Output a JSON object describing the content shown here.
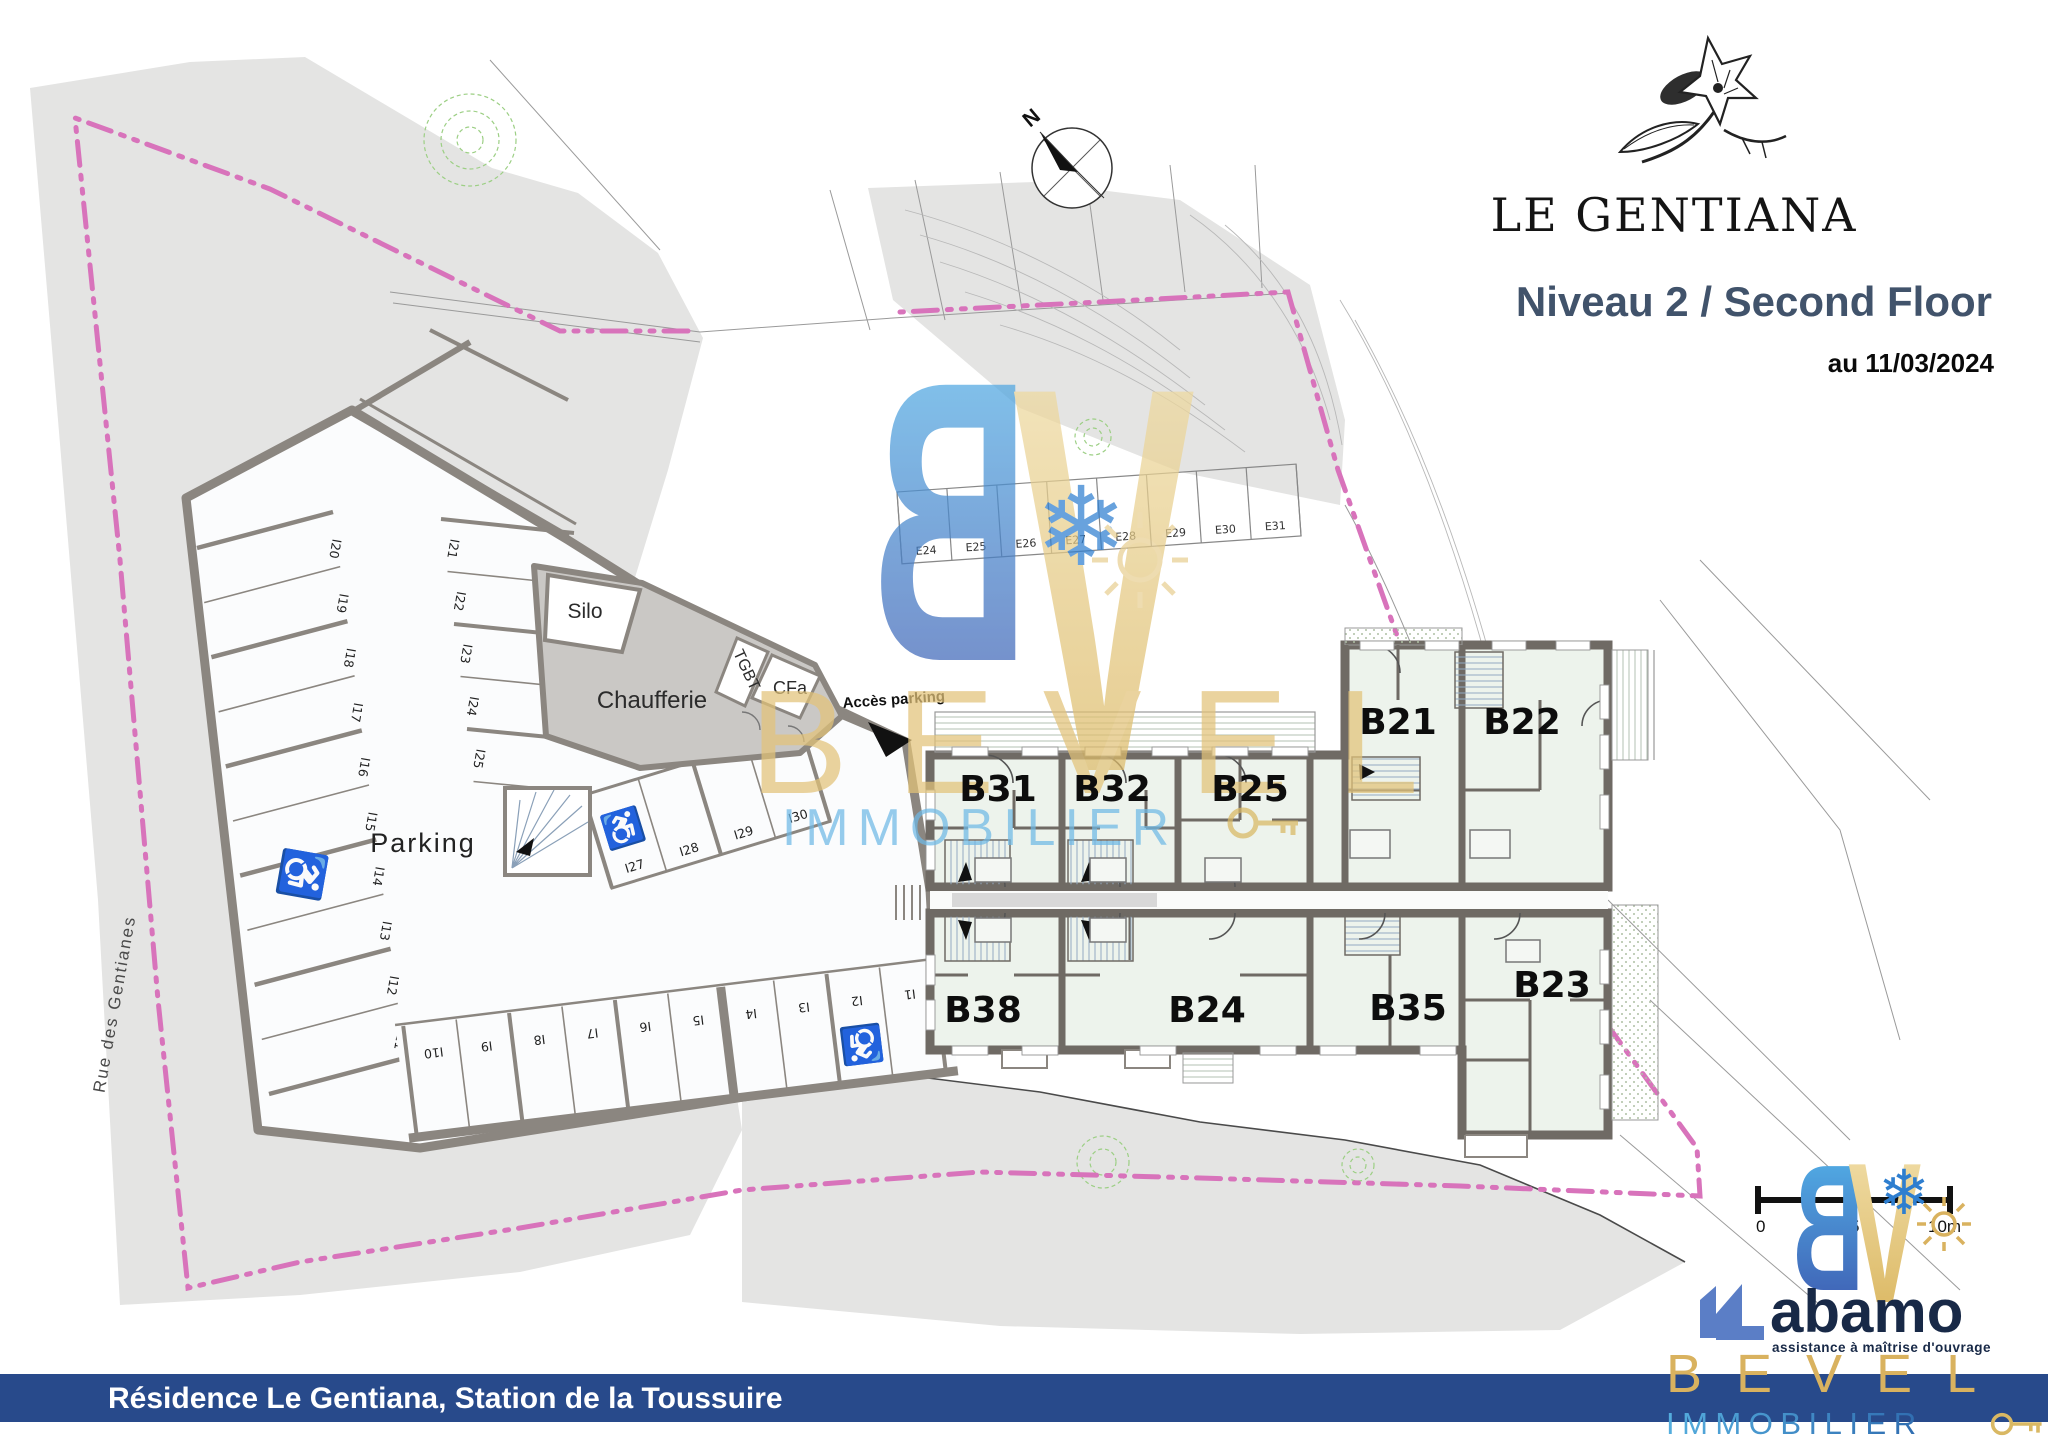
{
  "header": {
    "brand": "LE GENTIANA",
    "title": "Niveau 2 / Second Floor",
    "date": "au 11/03/2024"
  },
  "compass": {
    "north": "N"
  },
  "site": {
    "street": "Rue des Gentianes",
    "access_label": "Accès parking",
    "parking_label": "Parking",
    "silo": "Silo",
    "chaufferie": "Chaufferie",
    "tgbt": "TGBT",
    "cfa": "CFa"
  },
  "stalls": {
    "left": [
      "I20",
      "I19",
      "I18",
      "I17",
      "I16",
      "I15",
      "I14",
      "I13",
      "I12",
      "I11"
    ],
    "right": [
      "I21",
      "I22",
      "I23",
      "I24",
      "I25"
    ],
    "middle": [
      "I27",
      "I28",
      "I29",
      "I30"
    ],
    "bottom": [
      "I10",
      "I9",
      "I8",
      "I7",
      "I6",
      "I5",
      "I4",
      "I3",
      "I2",
      "I1"
    ],
    "exterior": [
      "E24",
      "E25",
      "E26",
      "E27",
      "E28",
      "E29",
      "E30",
      "E31"
    ]
  },
  "units": {
    "upper": [
      "B31",
      "B32",
      "B25"
    ],
    "wing": [
      "B21",
      "B22"
    ],
    "lower": [
      "B38",
      "B24",
      "B35",
      "B23"
    ]
  },
  "watermark": {
    "b": "B",
    "v": "V",
    "name": "BEVEL",
    "sector": "IMMOBILIER"
  },
  "scalebar": {
    "zero": "0",
    "five": "5",
    "ten": "10m"
  },
  "partners": {
    "abamo": "abamo",
    "abamo_tagline": "assistance à maîtrise d'ouvrage",
    "bevel": "BEVEL",
    "immobilier": "IMMOBILIER"
  },
  "footer": {
    "text": "Résidence Le Gentiana, Station de la Toussuire"
  },
  "colors": {
    "boundary": "#d873bb",
    "footer_bar": "#284a8b",
    "title": "#41536b",
    "gold": "#d9b25f",
    "blue": "#3f93cf",
    "terrain": "#e4e4e3",
    "unit_floor": "#edf3ec",
    "wall": "#6f6a64",
    "parking_wall": "#8b8680"
  }
}
